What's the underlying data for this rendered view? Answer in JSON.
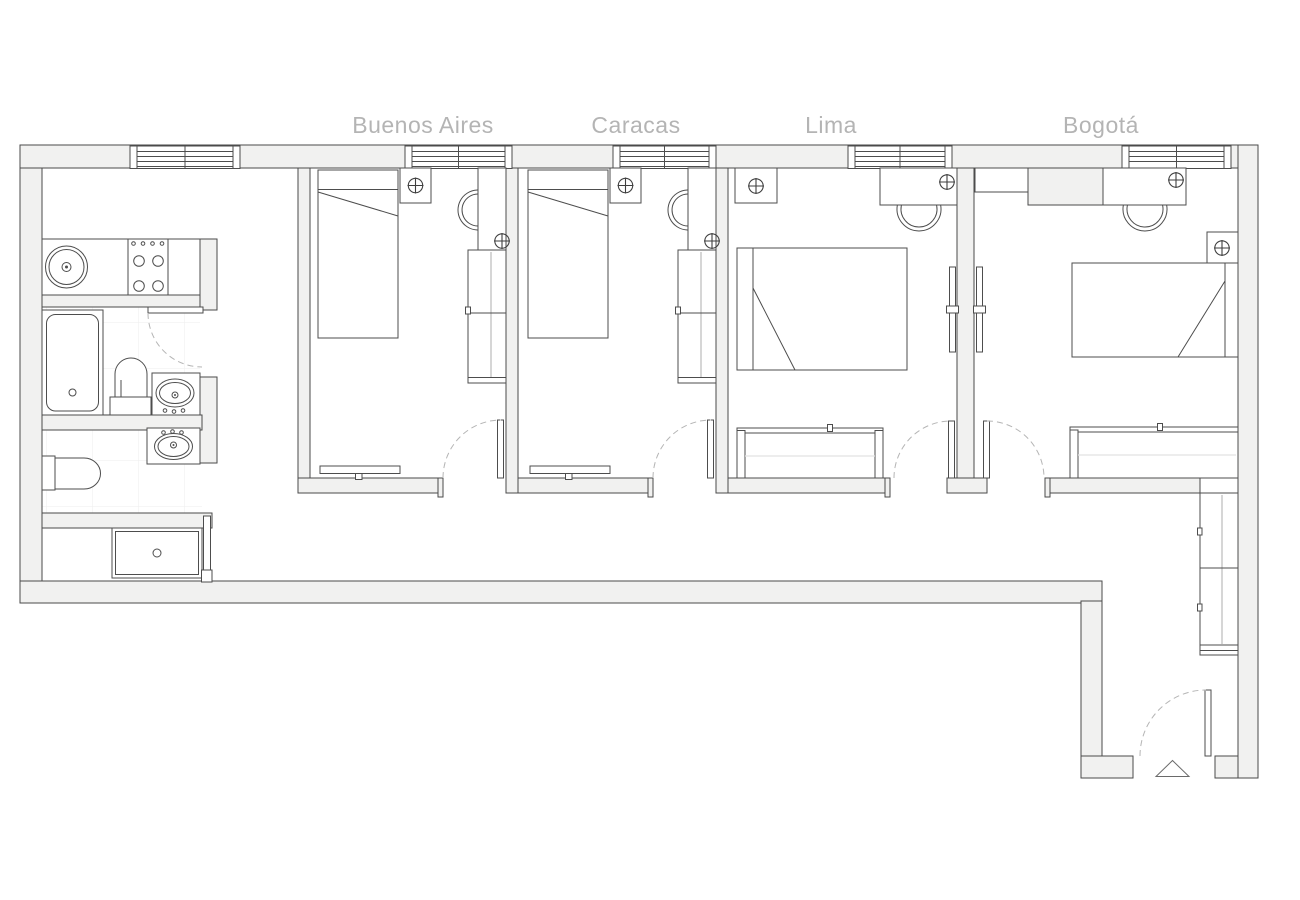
{
  "floor_plan": {
    "rooms": [
      {
        "id": "buenos-aires",
        "label": "Buenos Aires"
      },
      {
        "id": "caracas",
        "label": "Caracas"
      },
      {
        "id": "lima",
        "label": "Lima"
      },
      {
        "id": "bogota",
        "label": "Bogotá"
      }
    ],
    "colors": {
      "background": "#ffffff",
      "wall_fill": "#f1f1f0",
      "wall_outline": "#4a4a4a",
      "furniture_outline": "#4d4d4d",
      "soft_detail": "#d6d6d6",
      "door_swing_arc": "#b5b5b5",
      "room_label_text": "#b4b4b4",
      "tile_grid": "#f0f0f0"
    },
    "symbols": {
      "ceiling_light": "circle-with-cross",
      "entrance_marker": "triangle",
      "door_swing": "dashed-quarter-arc",
      "window": "multi-line-glazing"
    }
  }
}
